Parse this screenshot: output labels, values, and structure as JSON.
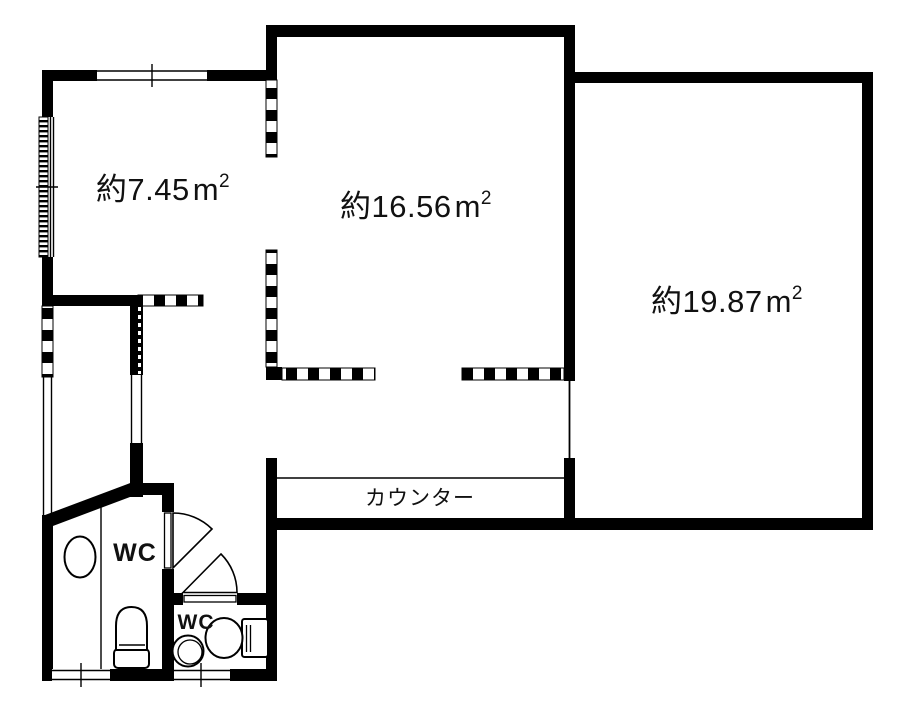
{
  "floorplan": {
    "background_color": "#ffffff",
    "wall_color": "#000000",
    "rooms": [
      {
        "name": "room-west",
        "area_value": "約7.45",
        "area_unit_base": "m",
        "area_unit_exponent": "2",
        "area_label_full": "約7.45㎡"
      },
      {
        "name": "room-center",
        "area_value": "約16.56",
        "area_unit_base": "m",
        "area_unit_exponent": "2",
        "area_label_full": "約16.56㎡"
      },
      {
        "name": "room-east",
        "area_value": "約19.87",
        "area_unit_base": "m",
        "area_unit_exponent": "2",
        "area_label_full": "約19.87㎡"
      }
    ],
    "counter": {
      "label": "カウンター"
    },
    "water_closets": [
      {
        "label": "WC"
      },
      {
        "label": "WC"
      }
    ]
  }
}
